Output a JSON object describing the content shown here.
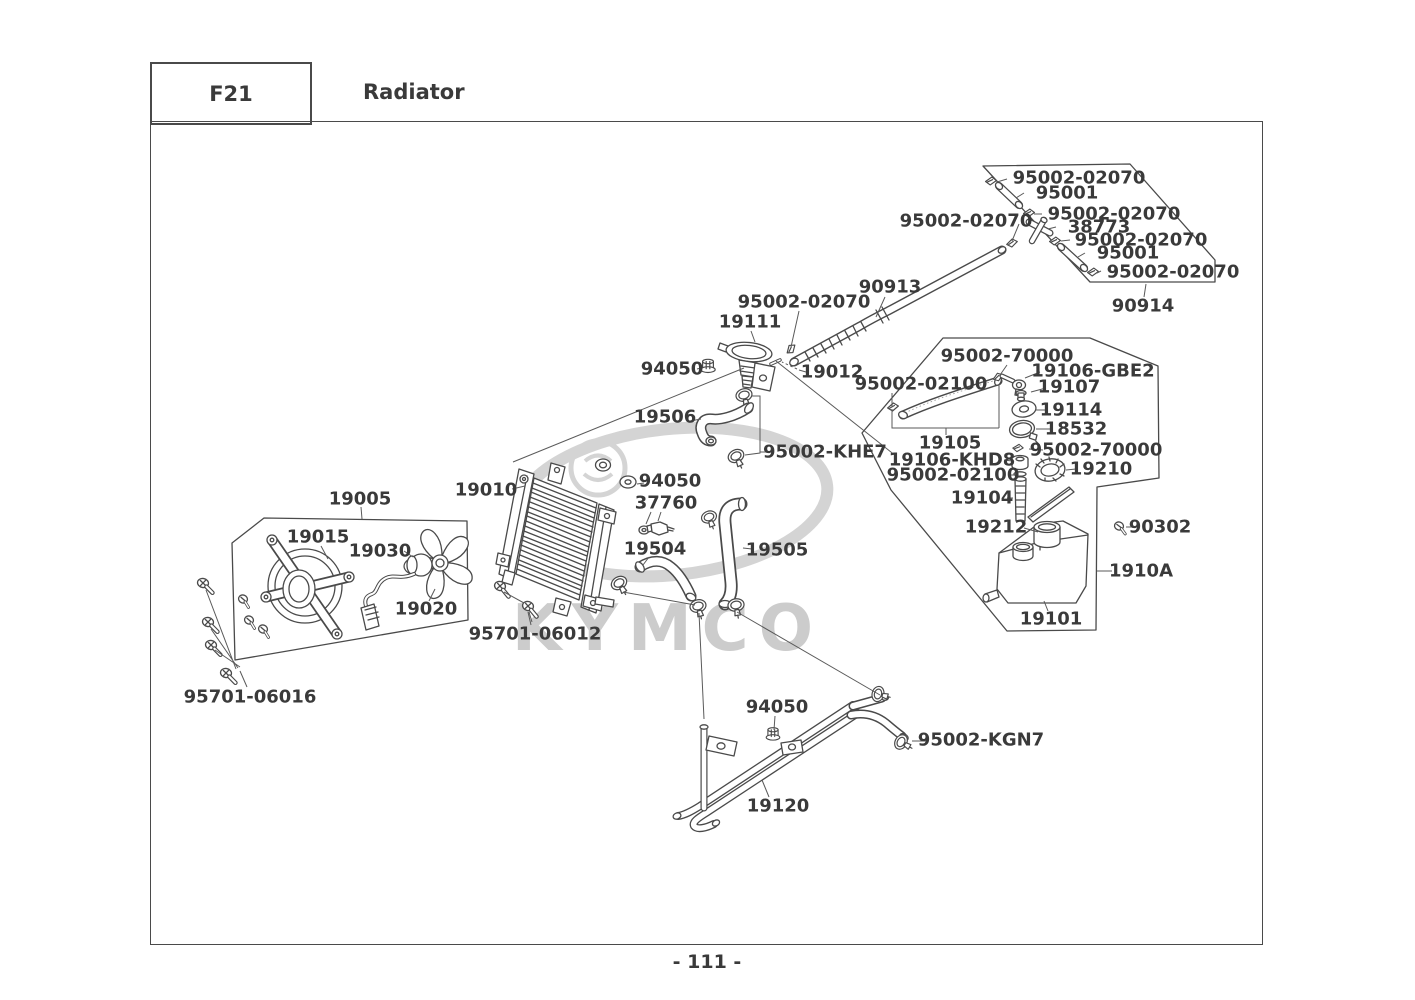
{
  "page": {
    "code": "F21",
    "title": "Radiator",
    "page_number": "- 111 -",
    "watermark_text": "KYMCO"
  },
  "colors": {
    "line": "#4a4a4a",
    "text": "#3a3a3a",
    "watermark": "#cccccc"
  },
  "diagram": {
    "labels": [
      {
        "text": "95002-02070",
        "x": 1079,
        "y": 178
      },
      {
        "text": "95001",
        "x": 1067,
        "y": 193
      },
      {
        "text": "95002-02070",
        "x": 1114,
        "y": 214
      },
      {
        "text": "38773",
        "x": 1099,
        "y": 227
      },
      {
        "text": "95002-02070",
        "x": 1141,
        "y": 240
      },
      {
        "text": "95001",
        "x": 1128,
        "y": 253
      },
      {
        "text": "95002-02070",
        "x": 1173,
        "y": 272
      },
      {
        "text": "90914",
        "x": 1143,
        "y": 306
      },
      {
        "text": "95002-02070",
        "x": 966,
        "y": 221
      },
      {
        "text": "90913",
        "x": 890,
        "y": 287
      },
      {
        "text": "95002-02070",
        "x": 804,
        "y": 302
      },
      {
        "text": "19111",
        "x": 750,
        "y": 322
      },
      {
        "text": "19012",
        "x": 832,
        "y": 372
      },
      {
        "text": "94050",
        "x": 672,
        "y": 369
      },
      {
        "text": "19506",
        "x": 665,
        "y": 417
      },
      {
        "text": "95002-KHE7",
        "x": 825,
        "y": 452
      },
      {
        "text": "95002-70000",
        "x": 1007,
        "y": 356
      },
      {
        "text": "19106-GBE2",
        "x": 1093,
        "y": 371
      },
      {
        "text": "95002-02100",
        "x": 921,
        "y": 384
      },
      {
        "text": "19107",
        "x": 1069,
        "y": 387
      },
      {
        "text": "19114",
        "x": 1071,
        "y": 410
      },
      {
        "text": "18532",
        "x": 1076,
        "y": 429
      },
      {
        "text": "19105",
        "x": 950,
        "y": 443
      },
      {
        "text": "95002-70000",
        "x": 1096,
        "y": 450
      },
      {
        "text": "19106-KHD8",
        "x": 952,
        "y": 460
      },
      {
        "text": "19210",
        "x": 1101,
        "y": 469
      },
      {
        "text": "95002-02100",
        "x": 953,
        "y": 475
      },
      {
        "text": "19104",
        "x": 982,
        "y": 498
      },
      {
        "text": "19212",
        "x": 996,
        "y": 527
      },
      {
        "text": "90302",
        "x": 1160,
        "y": 527
      },
      {
        "text": "1910A",
        "x": 1141,
        "y": 571
      },
      {
        "text": "19101",
        "x": 1051,
        "y": 619
      },
      {
        "text": "19010",
        "x": 486,
        "y": 490
      },
      {
        "text": "19005",
        "x": 360,
        "y": 499
      },
      {
        "text": "19015",
        "x": 318,
        "y": 537
      },
      {
        "text": "19030",
        "x": 380,
        "y": 551
      },
      {
        "text": "19020",
        "x": 426,
        "y": 609
      },
      {
        "text": "95701-06012",
        "x": 535,
        "y": 634
      },
      {
        "text": "95701-06016",
        "x": 250,
        "y": 697
      },
      {
        "text": "94050",
        "x": 670,
        "y": 481
      },
      {
        "text": "37760",
        "x": 666,
        "y": 503
      },
      {
        "text": "19504",
        "x": 655,
        "y": 549
      },
      {
        "text": "19505",
        "x": 777,
        "y": 550
      },
      {
        "text": "94050",
        "x": 777,
        "y": 707
      },
      {
        "text": "95002-KGN7",
        "x": 981,
        "y": 740
      },
      {
        "text": "19120",
        "x": 778,
        "y": 806
      }
    ]
  }
}
